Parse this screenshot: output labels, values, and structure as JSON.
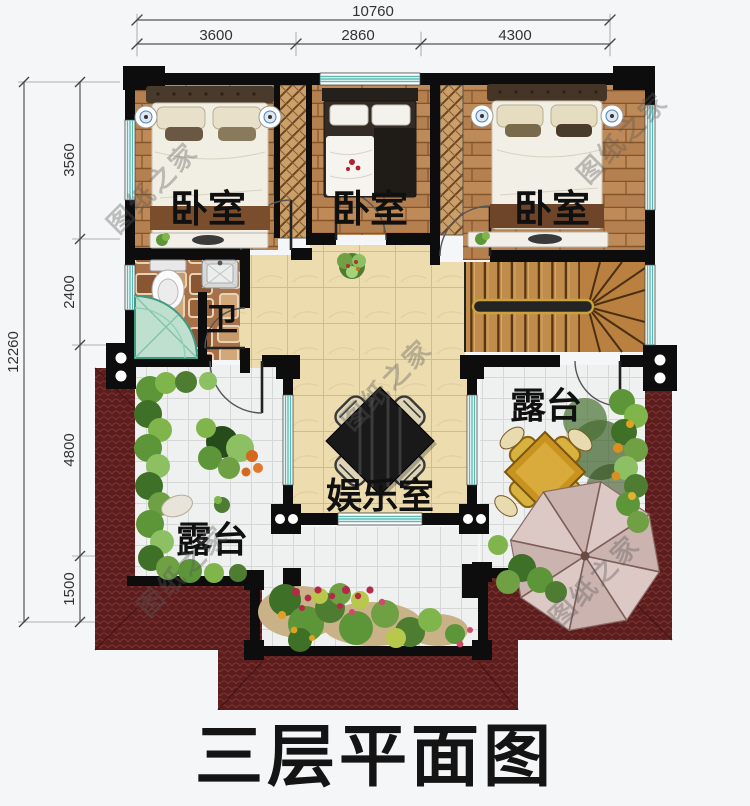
{
  "title": "三层平面图",
  "watermark_text": "图纸之家",
  "dimensions": {
    "top": {
      "total": "10760",
      "segments": [
        "3600",
        "2860",
        "4300"
      ]
    },
    "left": {
      "total": "12260",
      "segments": [
        "3560",
        "2400",
        "4800",
        "1500"
      ]
    }
  },
  "rooms": {
    "bedroom_left": "卧室",
    "bedroom_middle": "卧室",
    "bedroom_right": "卧室",
    "bathroom": "卫",
    "entertainment_room": "娱乐室",
    "terrace_left": "露台",
    "terrace_right": "露台"
  },
  "colors": {
    "roof": "#5c1d1d",
    "wall": "#0d0d0d",
    "wood_floor": "#b5804f",
    "marble_floor": "#ecdcae",
    "terrace_tile": "#eff0f0",
    "window": "#5bb8b2",
    "stair_rail": "#c9a23a",
    "greenery": "#5d9638",
    "title_text": "#141414"
  }
}
